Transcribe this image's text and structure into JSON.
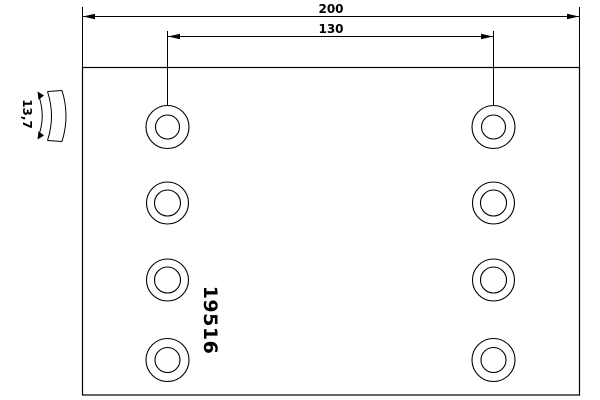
{
  "drawing": {
    "part_number": "19516",
    "dimensions": {
      "overall_length": "200",
      "hole_spacing": "130",
      "thickness": "13,7"
    },
    "holes": {
      "count": 8,
      "rows": 4,
      "columns": 2
    },
    "colors": {
      "line": "#000000",
      "background": "#ffffff"
    }
  }
}
